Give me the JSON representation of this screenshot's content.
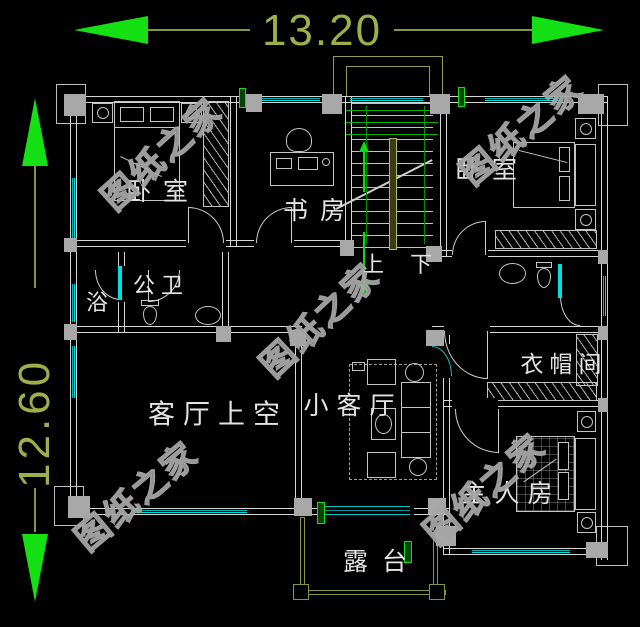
{
  "palette": {
    "background": "#000000",
    "wall_line": "#d6d6d6",
    "column_fill": "#a8a8a8",
    "window_cyan": "#00c8c8",
    "door_cyan": "#00e0e0",
    "dimension_text_green": "#9fae4a",
    "arrow_green": "#14e014",
    "stair_overlay_green": "#00b400",
    "railing_olive": "#8a9440",
    "handrail_olive": "#b8b868",
    "label_white": "#e4e4e4",
    "watermark_gray": "#a6a6a6"
  },
  "dimensions": {
    "top_width": "13.20",
    "left_height": "12.60"
  },
  "rooms": {
    "bedroom_left": "卧室",
    "study": "书房",
    "bedroom_right": "卧室",
    "bath": "浴",
    "public_wc": "公卫",
    "cloakroom": "衣帽间",
    "living_void": "客厅上空",
    "small_living": "小客厅",
    "master_bedroom": "主人房",
    "terrace": "露台"
  },
  "stairs": {
    "up": "上",
    "down": "下"
  },
  "watermark": {
    "text": "图纸之家"
  }
}
